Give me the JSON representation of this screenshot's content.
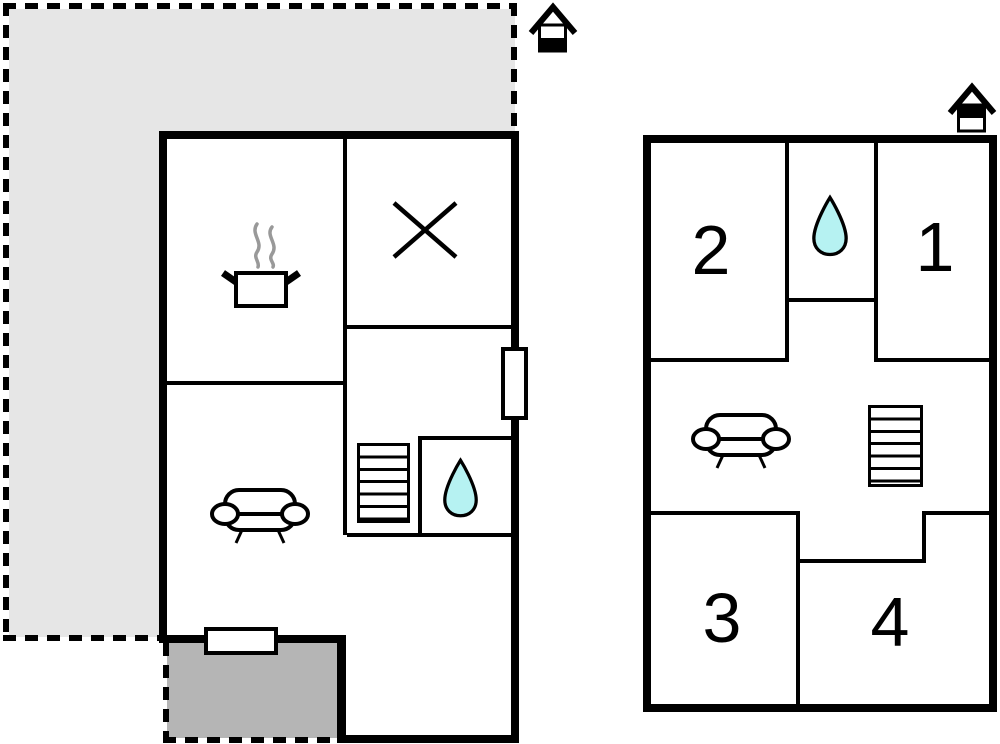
{
  "colors": {
    "wall": "#000000",
    "background": "#ffffff",
    "plot": "#e6e6e6",
    "terrace": "#b5b5b5",
    "water": "#b6f2f2",
    "steam": "#999999"
  },
  "ground_floor": {
    "symbols": {
      "kitchen": "cooking-pot-icon",
      "excluded_room": "cross-icon",
      "living_room": "sofa-icon",
      "stairs": "stairs-icon",
      "bathroom": "water-drop-icon",
      "entrance": "door-opening",
      "window": "window-opening",
      "orientation": "house-icon",
      "plot_boundary": "dashed-outline",
      "terrace": "shaded-area"
    }
  },
  "upper_floor": {
    "rooms": [
      {
        "id": "room-1",
        "label": "1"
      },
      {
        "id": "room-2",
        "label": "2"
      },
      {
        "id": "room-3",
        "label": "3"
      },
      {
        "id": "room-4",
        "label": "4"
      }
    ],
    "symbols": {
      "landing": "sofa-icon",
      "stairs": "stairs-icon",
      "bathroom": "water-drop-icon",
      "orientation": "house-icon"
    }
  }
}
